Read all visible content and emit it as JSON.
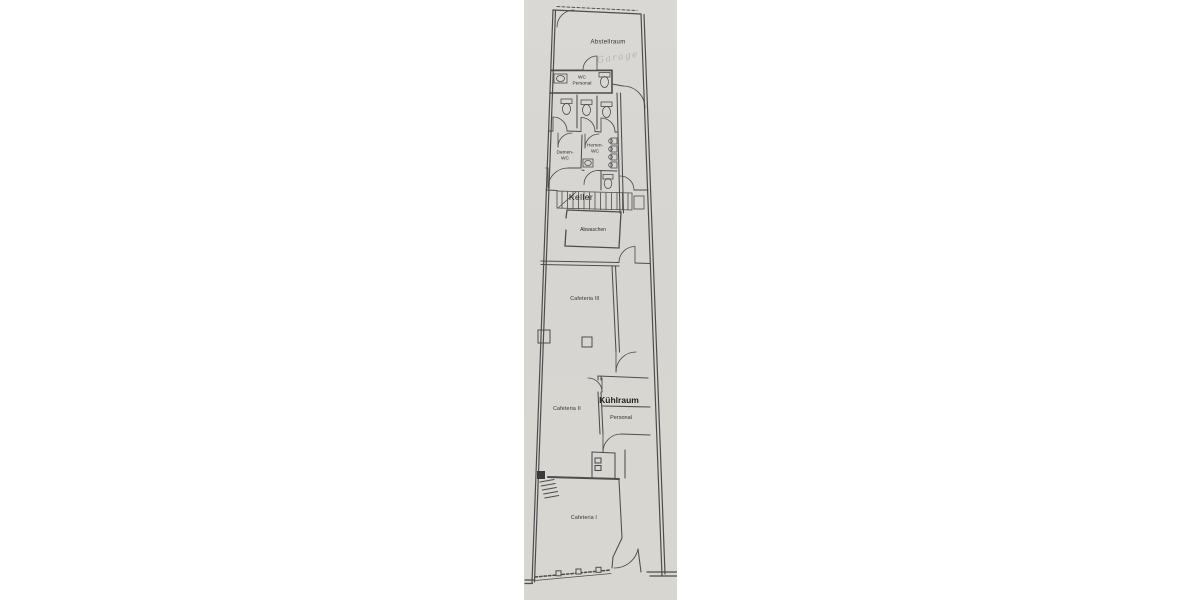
{
  "document": {
    "type": "scanned-floor-plan",
    "description": "Narrow scanned architectural floor plan strip of a cafeteria building"
  },
  "palette": {
    "page_background": "#ffffff",
    "scan_background": "#d8d6d2",
    "line_color": "#4d4d4d",
    "handwriting_color": "#b6b0a8"
  },
  "plan": {
    "rooms": [
      {
        "id": "abstellraum",
        "label": "Abstellraum"
      },
      {
        "id": "wc-personal",
        "label": "WC Personal"
      },
      {
        "id": "damen-wc",
        "label": "Damen-WC"
      },
      {
        "id": "herren-wc",
        "label": "Herren-WC"
      },
      {
        "id": "keller",
        "label": "Keller"
      },
      {
        "id": "abwaschen",
        "label": "Abwaschen"
      },
      {
        "id": "cafeteria-3",
        "label": "Cafeteria III"
      },
      {
        "id": "cafeteria-2",
        "label": "Cafeteria II"
      },
      {
        "id": "kuehlraum",
        "label": "Kühlraum"
      },
      {
        "id": "personal",
        "label": "Personal"
      },
      {
        "id": "cafeteria-1",
        "label": "Cafeteria I"
      }
    ],
    "annotations": [
      {
        "id": "handwritten-note",
        "text": "Garage"
      }
    ]
  }
}
